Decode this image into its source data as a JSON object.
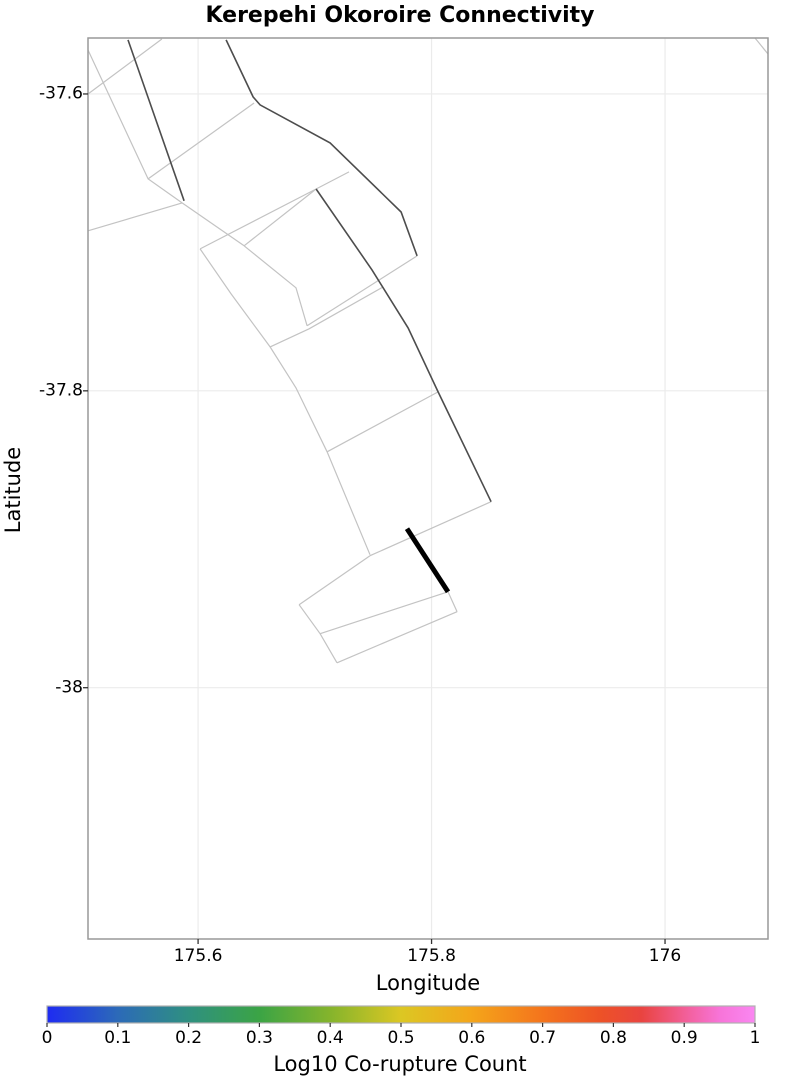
{
  "chart_data": {
    "type": "line",
    "title": "Kerepehi Okoroire Connectivity",
    "xlabel": "Longitude",
    "ylabel": "Latitude",
    "xlim": [
      175.5057,
      176.0882
    ],
    "ylim": [
      -38.1693,
      -37.5623
    ],
    "xticks": [
      175.6,
      175.8,
      176.0
    ],
    "xtick_labels": [
      "175.6",
      "175.8",
      "176"
    ],
    "yticks": [
      -37.6,
      -37.8,
      -38.0
    ],
    "ytick_labels": [
      "-37.6",
      "-37.8",
      "-38"
    ],
    "grid": true,
    "colors": {
      "fault_outline": "#c3c3c3",
      "fault_trace": "#4d4d4d",
      "highlight": "#000000",
      "grid": "#ebebeb",
      "frame": "#999999",
      "tick": "#333333",
      "colorbar_border": "#b0b0b0"
    },
    "series": [
      {
        "name": "fault-outlines",
        "role": "outline",
        "polylines": [
          [
            [
              175.569,
              -37.563
            ],
            [
              175.5057,
              -37.6
            ]
          ],
          [
            [
              175.5057,
              -37.5704
            ],
            [
              175.5572,
              -37.6572
            ],
            [
              175.5863,
              -37.6734
            ]
          ],
          [
            [
              175.5863,
              -37.6734
            ],
            [
              175.5057,
              -37.6922
            ]
          ],
          [
            [
              175.5863,
              -37.6734
            ],
            [
              175.6394,
              -37.7023
            ]
          ],
          [
            [
              175.6017,
              -37.7044
            ],
            [
              175.7011,
              -37.664
            ],
            [
              175.7293,
              -37.6525
            ]
          ],
          [
            [
              175.6394,
              -37.7023
            ],
            [
              175.7011,
              -37.664
            ]
          ],
          [
            [
              175.6394,
              -37.7023
            ],
            [
              175.6839,
              -37.7306
            ],
            [
              175.6934,
              -37.7562
            ]
          ],
          [
            [
              175.6017,
              -37.7044
            ],
            [
              175.6283,
              -37.7347
            ],
            [
              175.6617,
              -37.7704
            ],
            [
              175.6839,
              -37.798
            ],
            [
              175.7105,
              -37.8411
            ],
            [
              175.7473,
              -37.9104
            ]
          ],
          [
            [
              175.7876,
              -37.7091
            ],
            [
              175.6934,
              -37.7562
            ]
          ],
          [
            [
              175.7585,
              -37.73
            ],
            [
              175.6951,
              -37.7582
            ],
            [
              175.6617,
              -37.7704
            ]
          ],
          [
            [
              175.7105,
              -37.8411
            ],
            [
              175.8056,
              -37.8007
            ]
          ],
          [
            [
              175.7473,
              -37.9111
            ],
            [
              175.851,
              -37.8747
            ]
          ],
          [
            [
              175.648,
              -37.6061
            ],
            [
              175.5572,
              -37.6572
            ]
          ],
          [
            [
              175.6865,
              -37.9441
            ],
            [
              175.7473,
              -37.9111
            ]
          ],
          [
            [
              175.6865,
              -37.9441
            ],
            [
              175.7045,
              -37.9636
            ]
          ],
          [
            [
              175.7045,
              -37.9636
            ],
            [
              175.8141,
              -37.9354
            ]
          ],
          [
            [
              175.719,
              -37.9832
            ],
            [
              175.8219,
              -37.9488
            ]
          ],
          [
            [
              175.7045,
              -37.9636
            ],
            [
              175.719,
              -37.9832
            ]
          ],
          [
            [
              175.8219,
              -37.9488
            ],
            [
              175.8141,
              -37.9354
            ]
          ],
          [
            [
              176.0771,
              -37.5623
            ],
            [
              176.0882,
              -37.5731
            ]
          ]
        ]
      },
      {
        "name": "fault-traces",
        "role": "trace",
        "polylines": [
          [
            [
              175.54,
              -37.5636
            ],
            [
              175.588,
              -37.672
            ]
          ],
          [
            [
              175.624,
              -37.5636
            ],
            [
              175.6471,
              -37.602
            ],
            [
              175.6531,
              -37.6074
            ],
            [
              175.7131,
              -37.633
            ],
            [
              175.7739,
              -37.6795
            ],
            [
              175.7876,
              -37.7091
            ]
          ],
          [
            [
              175.7011,
              -37.664
            ],
            [
              175.749,
              -37.7185
            ],
            [
              175.7799,
              -37.7576
            ],
            [
              175.8056,
              -37.8007
            ],
            [
              175.851,
              -37.8747
            ]
          ]
        ]
      },
      {
        "name": "kerepehi-okoroire-highlight",
        "role": "highlight",
        "polylines": [
          [
            [
              175.779,
              -37.8929
            ],
            [
              175.8141,
              -37.9354
            ]
          ]
        ]
      }
    ],
    "colorbar": {
      "label": "Log10 Co-rupture Count",
      "min": 0,
      "max": 1,
      "ticks": [
        0,
        0.1,
        0.2,
        0.3,
        0.4,
        0.5,
        0.6,
        0.7,
        0.8,
        0.9,
        1
      ],
      "tick_labels": [
        "0",
        "0.1",
        "0.2",
        "0.3",
        "0.4",
        "0.5",
        "0.6",
        "0.7",
        "0.8",
        "0.9",
        "1"
      ],
      "gradient_stops": [
        {
          "pos": 0.0,
          "color": "#1e2bf2"
        },
        {
          "pos": 0.1,
          "color": "#2c6ab8"
        },
        {
          "pos": 0.2,
          "color": "#2f9080"
        },
        {
          "pos": 0.3,
          "color": "#3ba445"
        },
        {
          "pos": 0.4,
          "color": "#85b42c"
        },
        {
          "pos": 0.5,
          "color": "#dcc723"
        },
        {
          "pos": 0.6,
          "color": "#f4a51a"
        },
        {
          "pos": 0.7,
          "color": "#f4741c"
        },
        {
          "pos": 0.78,
          "color": "#ed5226"
        },
        {
          "pos": 0.84,
          "color": "#e94440"
        },
        {
          "pos": 0.9,
          "color": "#f25e96"
        },
        {
          "pos": 0.95,
          "color": "#f774d8"
        },
        {
          "pos": 1.0,
          "color": "#fa87f2"
        }
      ]
    }
  }
}
